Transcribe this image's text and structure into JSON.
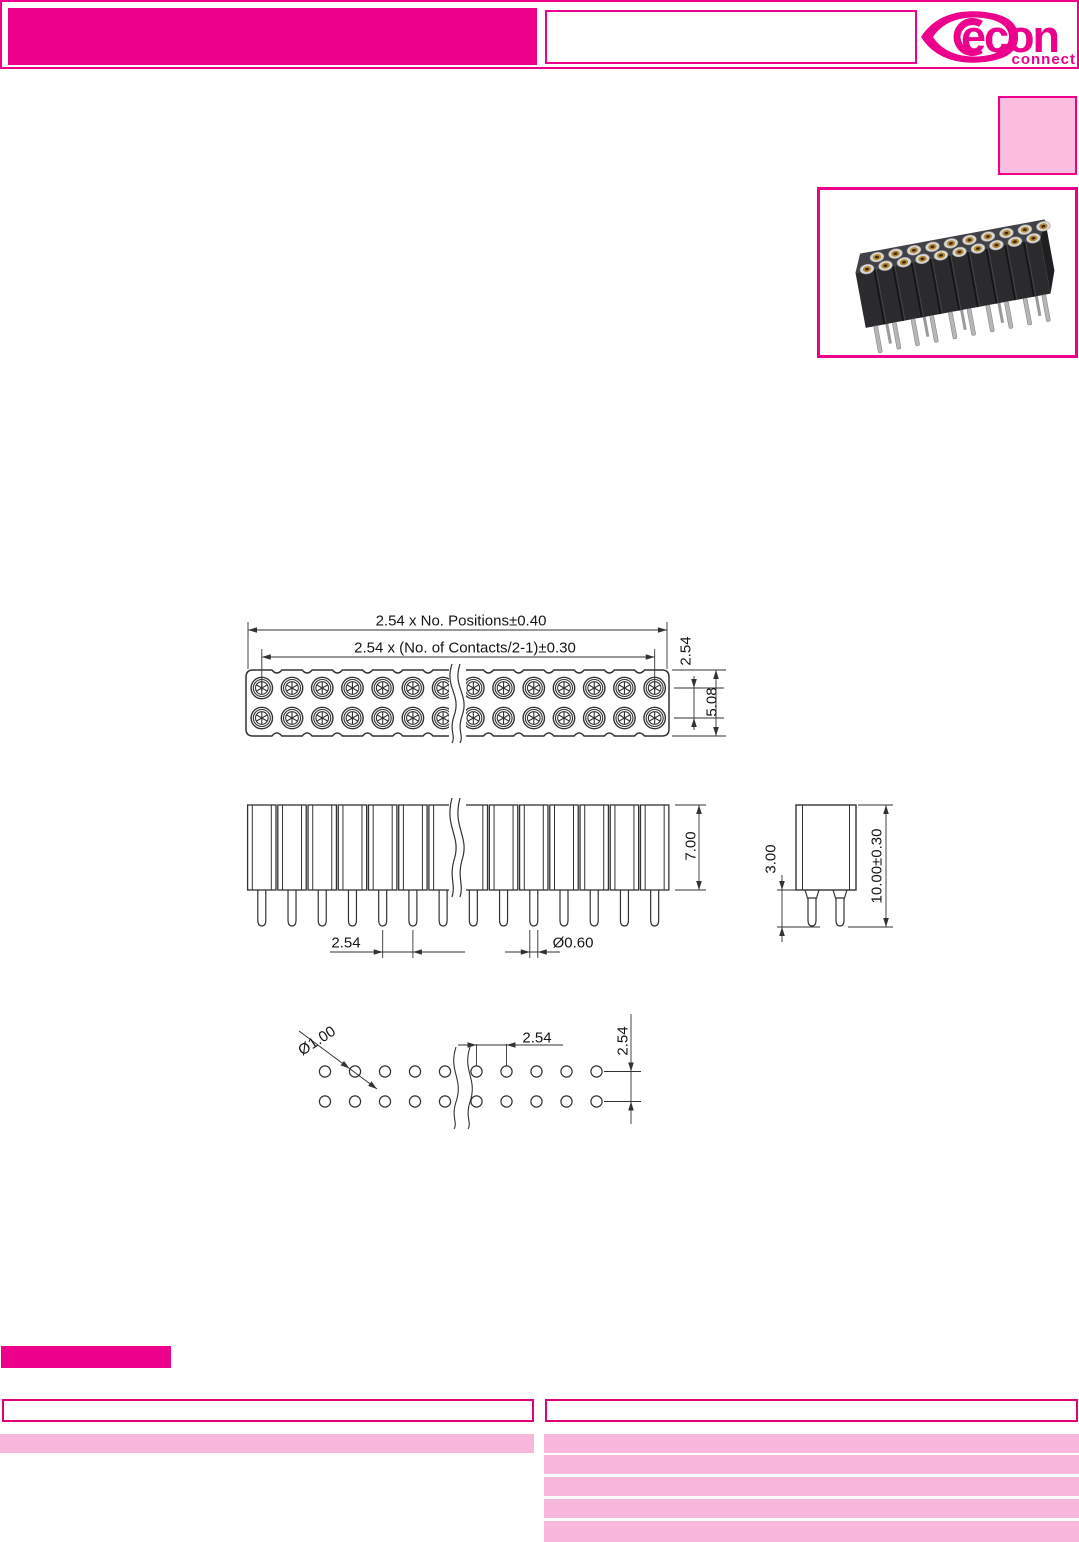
{
  "brand": {
    "name": "econ",
    "tagline": "connect"
  },
  "colors": {
    "magenta": "#EC008C",
    "pink_light": "#F9B7DC",
    "pink_fill": "#FBBDDE",
    "drawing_line": "#333333"
  },
  "header": {
    "title_box": ""
  },
  "drawings": {
    "top_view": {
      "dim_total_width": "2.54 x No. Positions±0.40",
      "dim_contact_span": "2.54 x (No. of Contacts/2-1)±0.30",
      "dim_row_pitch": "2.54",
      "dim_body_width": "5.08"
    },
    "front_view": {
      "dim_insulator_height": "7.00",
      "dim_pitch": "2.54",
      "dim_pin_diameter": "Ø0.60"
    },
    "side_view": {
      "dim_pin_length": "3.00",
      "dim_overall_height": "10.00±0.30"
    },
    "pcb_layout": {
      "dim_hole_diameter": "Ø1.00",
      "dim_pitch": "2.54",
      "dim_row_spacing": "2.54"
    }
  },
  "footer": {
    "left_header": "",
    "right_header": ""
  }
}
